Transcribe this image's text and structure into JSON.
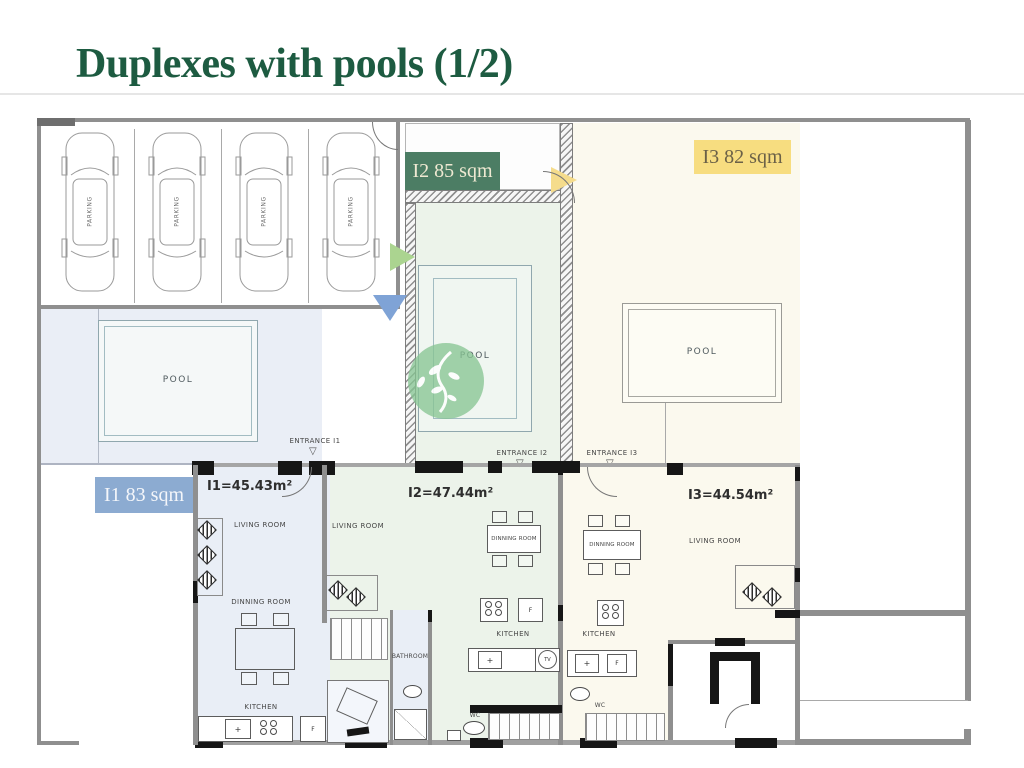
{
  "title": {
    "bold": "Duplexes",
    "rest": " with pools (1/2)"
  },
  "badges": [
    {
      "unit": "I1",
      "label": "I1 83 sqm",
      "color": "#8cabd1"
    },
    {
      "unit": "I2",
      "label": "I2 85 sqm",
      "color": "#4c7d64"
    },
    {
      "unit": "I3",
      "label": "I3 82 sqm",
      "color": "#f7dd80"
    }
  ],
  "units": [
    {
      "name": "I1",
      "area_label": "I1=45.43m²"
    },
    {
      "name": "I2",
      "area_label": "I2=47.44m²"
    },
    {
      "name": "I3",
      "area_label": "I3=44.54m²"
    }
  ],
  "entrances": [
    {
      "label": "ENTRANCE I1"
    },
    {
      "label": "ENTRANCE I2"
    },
    {
      "label": "ENTRANCE I3"
    }
  ],
  "room_labels": {
    "pool": "POOL",
    "living_room": "LIVING ROOM",
    "dining_room": "DINNING ROOM",
    "kitchen": "KITCHEN",
    "bathroom": "BATHROOM",
    "wc": "WC",
    "parking": "PARKING"
  },
  "fixtures": {
    "fridge": "F",
    "tv": "TV",
    "sink": "+"
  },
  "icons": {
    "entrance_triangle": "▽"
  },
  "colors": {
    "title_green": "#1d5b41",
    "badge_green": "#4c7d64",
    "badge_yellow": "#f7dd80",
    "badge_blue": "#8cabd1",
    "unit1_fill": "#e9eef6",
    "unit2_fill": "#ecf3ea",
    "unit3_fill": "#fbf9ee",
    "arrow_green": "#abd490",
    "arrow_blue": "#7fa3d6",
    "arrow_yellow": "#f5dc8c",
    "wall_gray": "#8f8f8f",
    "watermark_green": "#86c492"
  }
}
